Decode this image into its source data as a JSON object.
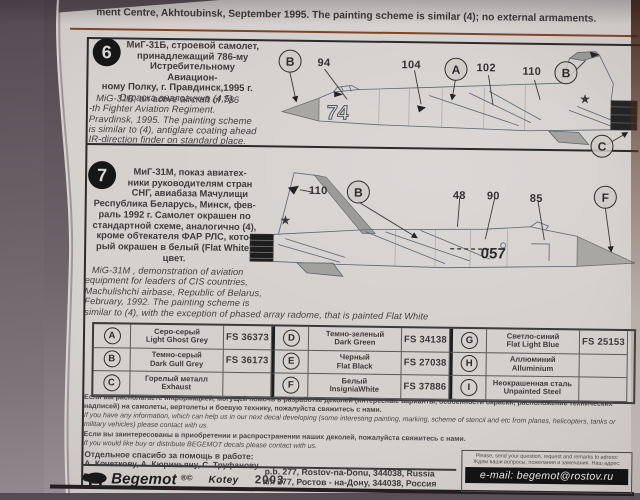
{
  "top_caption": "ment Centre,  Akhtoubinsk,  September 1995. The painting scheme is similar  (4);  no external armaments.",
  "section6": {
    "badge": "6",
    "board_number": "74",
    "star": "★",
    "ru_lines": [
      "МиГ-31Б,  строевой самолет,",
      "принадлежащий 786-му",
      "Истребительному Авиацион-",
      "ному Полку,  г. Правдинск,1995 г.",
      "Окраска аналогична (4,5)."
    ],
    "en_lines": [
      "MiG-31B,  an active aircraft of 786",
      "-th Fighter  Aviation Regiment.",
      "Pravdinsk,  1995. The painting scheme",
      "is similar  to (4),  antiglare coating ahead",
      "IR-direction finder  on standard place."
    ],
    "callouts": {
      "b1": "B",
      "n94": "94",
      "n104": "104",
      "a": "A",
      "n102": "102",
      "n110": "110",
      "b2": "B",
      "c": "C"
    }
  },
  "section7": {
    "badge": "7",
    "board_number": "057",
    "star": "★",
    "ru_lines": [
      "МиГ-31М,  показ авиатех-",
      "ники руководителям стран",
      "СНГ,  авиабаза Мачулищи",
      "Республика Беларусь,  Минск,  фев-",
      "раль 1992 г. Самолет окрашен по",
      "стандартной схеме,  аналогично (4),",
      "кроме  обтекателя ФАР РЛС,  кото-",
      "рый окрашен в белый (Flat White)",
      "цвет."
    ],
    "en_lines": [
      "MiG-31M ,  demonstration of aviation",
      "equipment for  leaders of CIS countries,",
      "Machulishchi airbase,  Republic of Belarus,",
      "February,  1992. The painting scheme is",
      "similar  to (4),  with the exception of phased array radome,  that is painted Flat White"
    ],
    "callouts": {
      "n110": "110",
      "b": "B",
      "n48": "48",
      "n90": "90",
      "n85": "85",
      "f": "F"
    }
  },
  "color_table": {
    "cells": [
      {
        "letter": "A",
        "ru": "Серо-серый",
        "en": "Light Ghost Grey",
        "fs": "FS 36373"
      },
      {
        "letter": "D",
        "ru": "Темно-зеленый",
        "en": "Dark Green",
        "fs": "FS 34138"
      },
      {
        "letter": "G",
        "ru": "Светло-синий",
        "en": "Flat Light Blue",
        "fs": "FS 25153"
      },
      {
        "letter": "B",
        "ru": "Темно-серый",
        "en": "Dark Gull Grey",
        "fs": "FS 36173"
      },
      {
        "letter": "E",
        "ru": "Черный",
        "en": "Flat Black",
        "fs": "FS 27038"
      },
      {
        "letter": "H",
        "ru": "Аллюминий",
        "en": "Alluminium",
        "fs": ""
      },
      {
        "letter": "C",
        "ru": "Горелый металл",
        "en": "Exhaust",
        "fs": ""
      },
      {
        "letter": "F",
        "ru": "Белый",
        "en": "InsigniaWhite",
        "fs": "FS 37886"
      },
      {
        "letter": "I",
        "ru": "Неокрашенная сталь",
        "en": "Unpainted Steel",
        "fs": ""
      }
    ]
  },
  "notes": {
    "ru1": "Если вы располагаете информацией,  могущей помочь в разработке деколей (интересные варианты,  особенности окраски,  расположение технических надписей) на самолеты,  вертолеты и боевую технику,  пожалуйста свяжитесь с нами.",
    "en1": "If you have any information,  which can help us in our next decal  developing (some interesting painting,  marking,  scheme of stencil and etc  from  planes, helicopters,  tanks or military vehicles) please contact with us.",
    "ru2": "Если вы заинтересованы в приобретении  и распространении наших деколей,  пожалуйста свяжитесь с  нами.",
    "en2": "If you would like buy or  distribute BEGEMOT decals please contact with us."
  },
  "thanks": {
    "line1": "Отдельное спасибо за помощь в работе:",
    "line2": "А. Кочеткову,  А. Кюриньяну,  С. Труфанову."
  },
  "footer": {
    "brand": "Begemot",
    "marks": "®©",
    "kotey": "Kotey",
    "year": "2003",
    "address_en": "p.b. 277,  Rostov-na-Donu,  344038,  Russia",
    "address_ru": "а/я 277,  Ростов - на-Дону,  344038,  Россия",
    "contact_en": "Please,  send your question,  request and remarks to adress:",
    "contact_ru": "Ждем ваши вопросы,  пожелания и замечания. Наш адрес:",
    "email": "e-mail: begemot@rostov.ru"
  }
}
